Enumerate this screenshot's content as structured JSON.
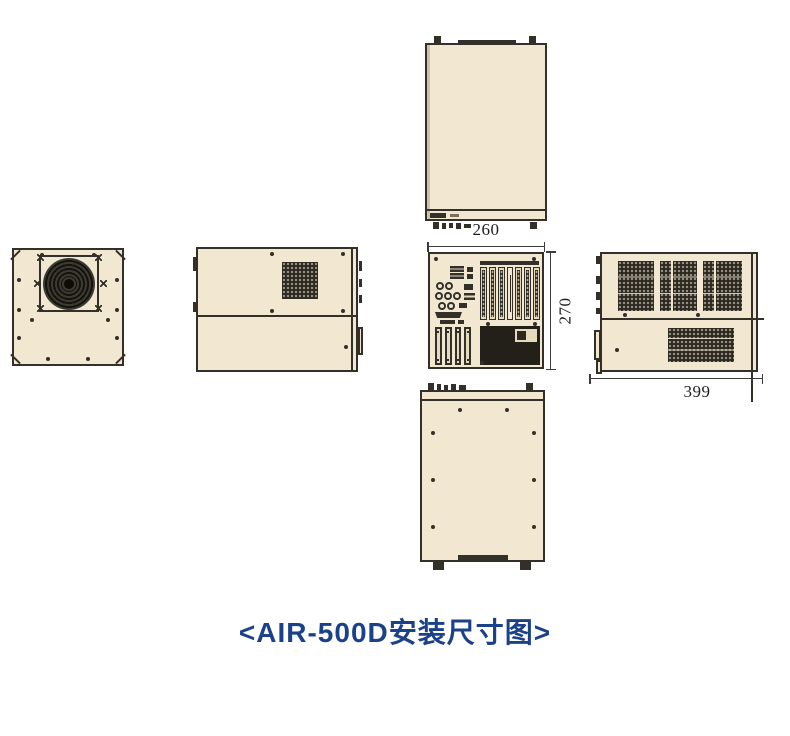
{
  "caption": "<AIR-500D安装尺寸图>",
  "dimensions": {
    "rear_width_mm": "260",
    "rear_height_mm": "270",
    "side_depth_mm": "399"
  },
  "colors": {
    "panel_fill": "#f2e8d2",
    "outline": "#33302a",
    "vent_dark": "#2b281f",
    "caption_blue": "#1b4189",
    "background": "#ffffff"
  },
  "views": {
    "top": "top-view",
    "front_fan": "front-view-with-fan",
    "side_left": "left-side-view",
    "rear": "rear-io-view",
    "side_right": "right-side-view",
    "bottom": "bottom-view"
  }
}
